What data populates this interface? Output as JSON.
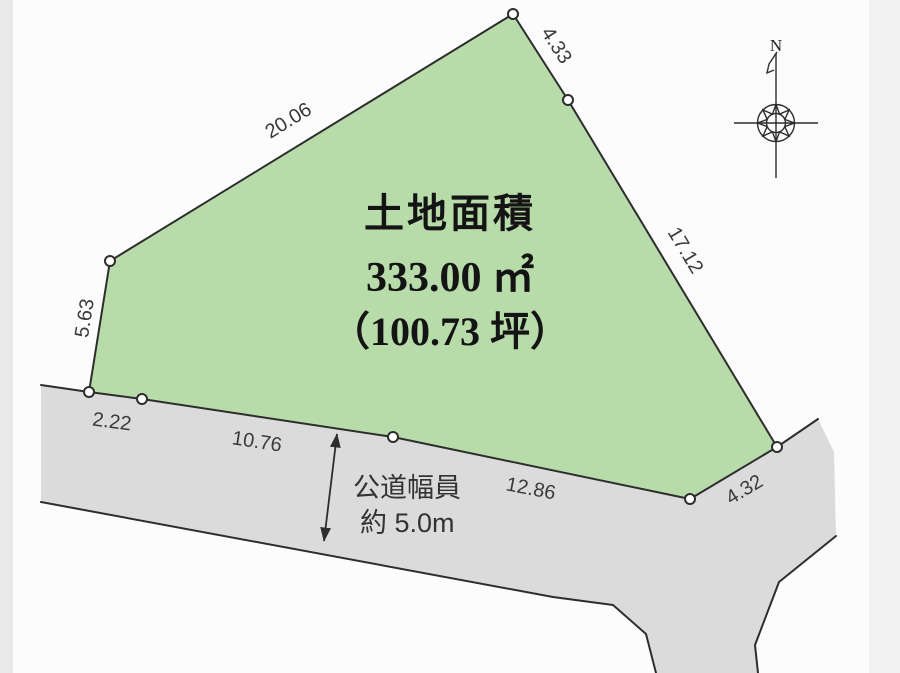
{
  "area": {
    "heading": "土地面積",
    "square_meters": "333.00 ㎡",
    "tsubo": "（100.73 坪）"
  },
  "dimensions": {
    "nw": "20.06",
    "n": "4.33",
    "e": "17.12",
    "w": "5.63",
    "sw1": "2.22",
    "sw2": "10.76",
    "s": "12.86",
    "se": "4.32"
  },
  "road": {
    "width_label_line1": "公道幅員",
    "width_label_line2": "約 5.0m"
  },
  "compass": {
    "north": "N"
  },
  "colors": {
    "parcel_fill": "#b8dbaa",
    "road_fill": "#dbdbdb",
    "outline": "#2d2d2d"
  }
}
